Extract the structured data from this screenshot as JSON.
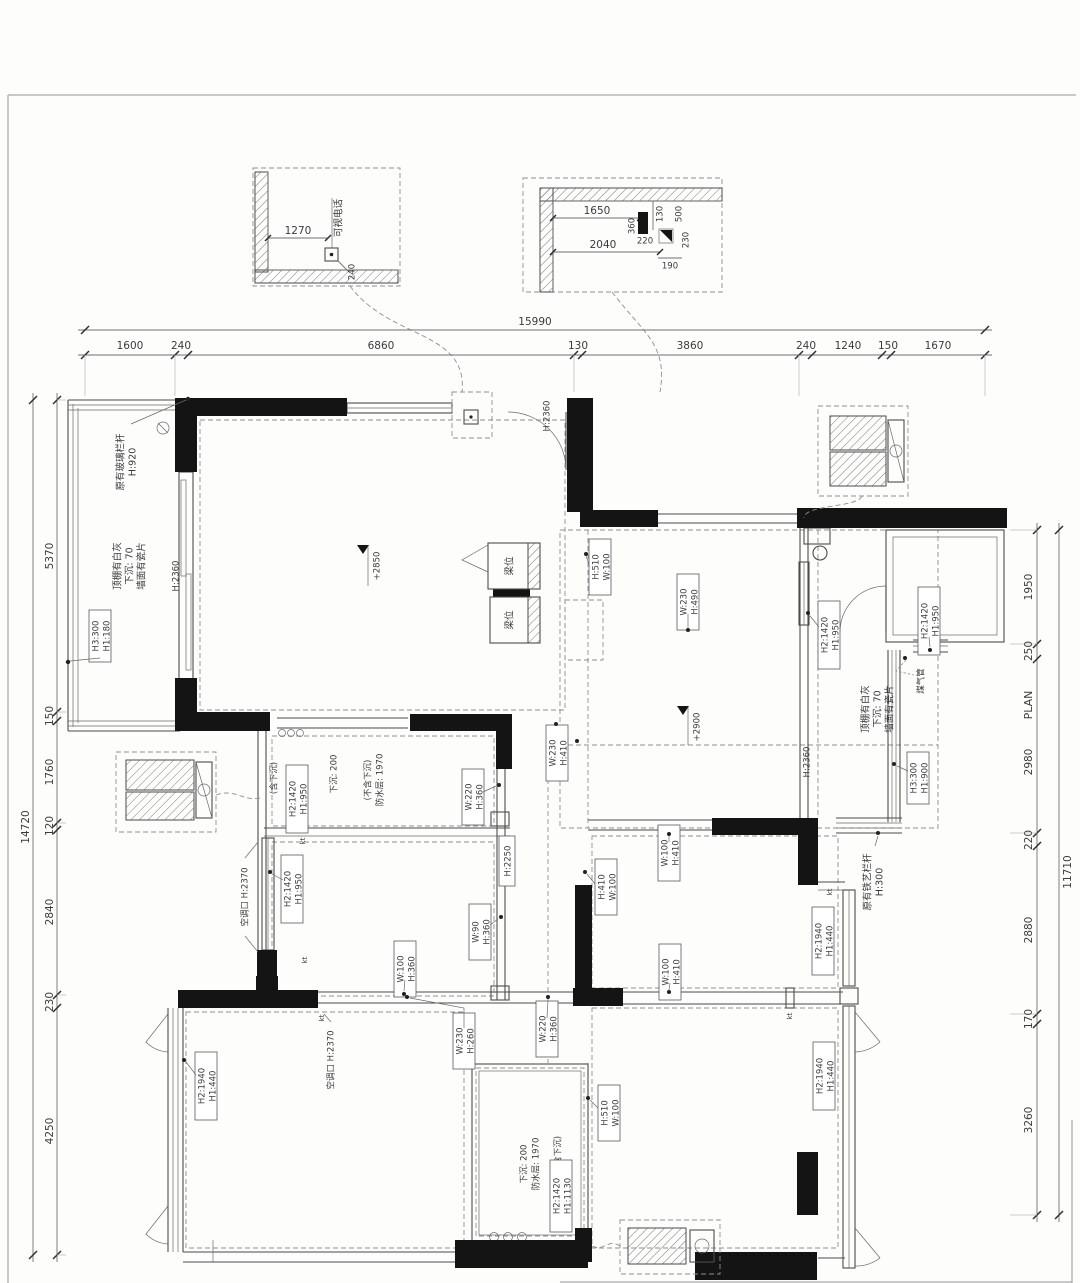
{
  "page": {
    "plan_label": "PLAN"
  },
  "dims": {
    "top": {
      "total": "15990",
      "segments": [
        "1600",
        "240",
        "6860",
        "130",
        "3860",
        "240",
        "1240",
        "150",
        "1670"
      ]
    },
    "left": {
      "total": "14720",
      "segments": [
        "5370",
        "150",
        "1760",
        "120",
        "2840",
        "230",
        "4250"
      ]
    },
    "right": {
      "total": "11710",
      "segments": [
        "1950",
        "250",
        "2980",
        "220",
        "2880",
        "170",
        "3260"
      ]
    }
  },
  "callout_intercom": {
    "label": "可视电话",
    "d1270": "1270",
    "d240": "240"
  },
  "callout_ceiling": {
    "d1650": "1650",
    "d2040": "2040",
    "d220": "220",
    "d190": "190",
    "d130": "130",
    "d360": "360",
    "d500": "500",
    "d230": "230"
  },
  "levels": {
    "living": "+2850",
    "dining": "+2900"
  },
  "ann": {
    "glass_rail": {
      "l1": "原有玻璃栏杆",
      "l2": "H:920"
    },
    "balc_ceiling": {
      "l1": "顶棚有白灰",
      "l2": "下沉: 70",
      "l3": "墙面有瓷片"
    },
    "balc_window": {
      "l1": "H3:300",
      "l2": "H1:180"
    },
    "balc_slide_door": "H:2360",
    "entry_door": "H:2360",
    "beam_pos": "梁位",
    "beam_entry": {
      "l1": "H:510",
      "l2": "W:100"
    },
    "beam_dining_top": {
      "l1": "W:230",
      "l2": "H:490"
    },
    "beam_hall": {
      "l1": "W:230",
      "l2": "H:410"
    },
    "beam_dining_n": {
      "l1": "W:100",
      "l2": "H:410"
    },
    "beam_dining_w": {
      "l1": "H:410",
      "l2": "W:100"
    },
    "beam_dining_s": {
      "l1": "W:100",
      "l2": "H:410"
    },
    "beam_bath2": {
      "l1": "H:510",
      "l2": "W:100"
    },
    "beam_hall_s": {
      "l1": "W:220",
      "l2": "H:360"
    },
    "beam_bed3": {
      "l1": "W:230",
      "l2": "H:260"
    },
    "hall_h": "H:2250",
    "bath1_incl": "(含下沉)",
    "bath1_window": {
      "l1": "H2:1420",
      "l2": "H1:950"
    },
    "bath1_sunk": "下沉: 200",
    "bath1_wp": {
      "l1": "防水层: 1970",
      "l2": "(不含下沉)"
    },
    "bath1_win_beam": {
      "l1": "W:220",
      "l2": "H:360"
    },
    "bed2_window": {
      "l1": "H2:1420",
      "l2": "H1:950"
    },
    "bed2_beam_e": {
      "l1": "W:90",
      "l2": "H:360"
    },
    "bed2_beam_s": {
      "l1": "W:100",
      "l2": "H:360"
    },
    "ac_opening_1": "空调口 H:2370",
    "ac_opening_2": "空调口 H:2370",
    "bed3_window": {
      "l1": "H2:1940",
      "l2": "H1:440"
    },
    "bath2_incl": "(含下沉)",
    "bath2_window": {
      "l1": "H2:1420",
      "l2": "H1:1130"
    },
    "bath2_wp": {
      "l1": "防水层: 1970",
      "l2": "下沉: 200"
    },
    "kitchen_window_w": {
      "l1": "H2:1420",
      "l2": "H1:950"
    },
    "kitchen_window_n": {
      "l1": "H2:1420",
      "l2": "H1:950"
    },
    "gas_pipe": "煤气管",
    "kitchen_ceiling": {
      "l1": "顶棚有白灰",
      "l2": "下沉: 70",
      "l3": "墙面有瓷片"
    },
    "kitchen_balc_window": {
      "l1": "H3:300",
      "l2": "H1:900"
    },
    "iron_rail": {
      "l1": "原有铁艺栏杆",
      "l2": "H:300"
    },
    "kitchen_slide_door": "H:2360",
    "dining_window": {
      "l1": "H2:1940",
      "l2": "H1:440"
    },
    "bed4_window": {
      "l1": "H2:1940",
      "l2": "H1:440"
    },
    "kt": "kt"
  }
}
